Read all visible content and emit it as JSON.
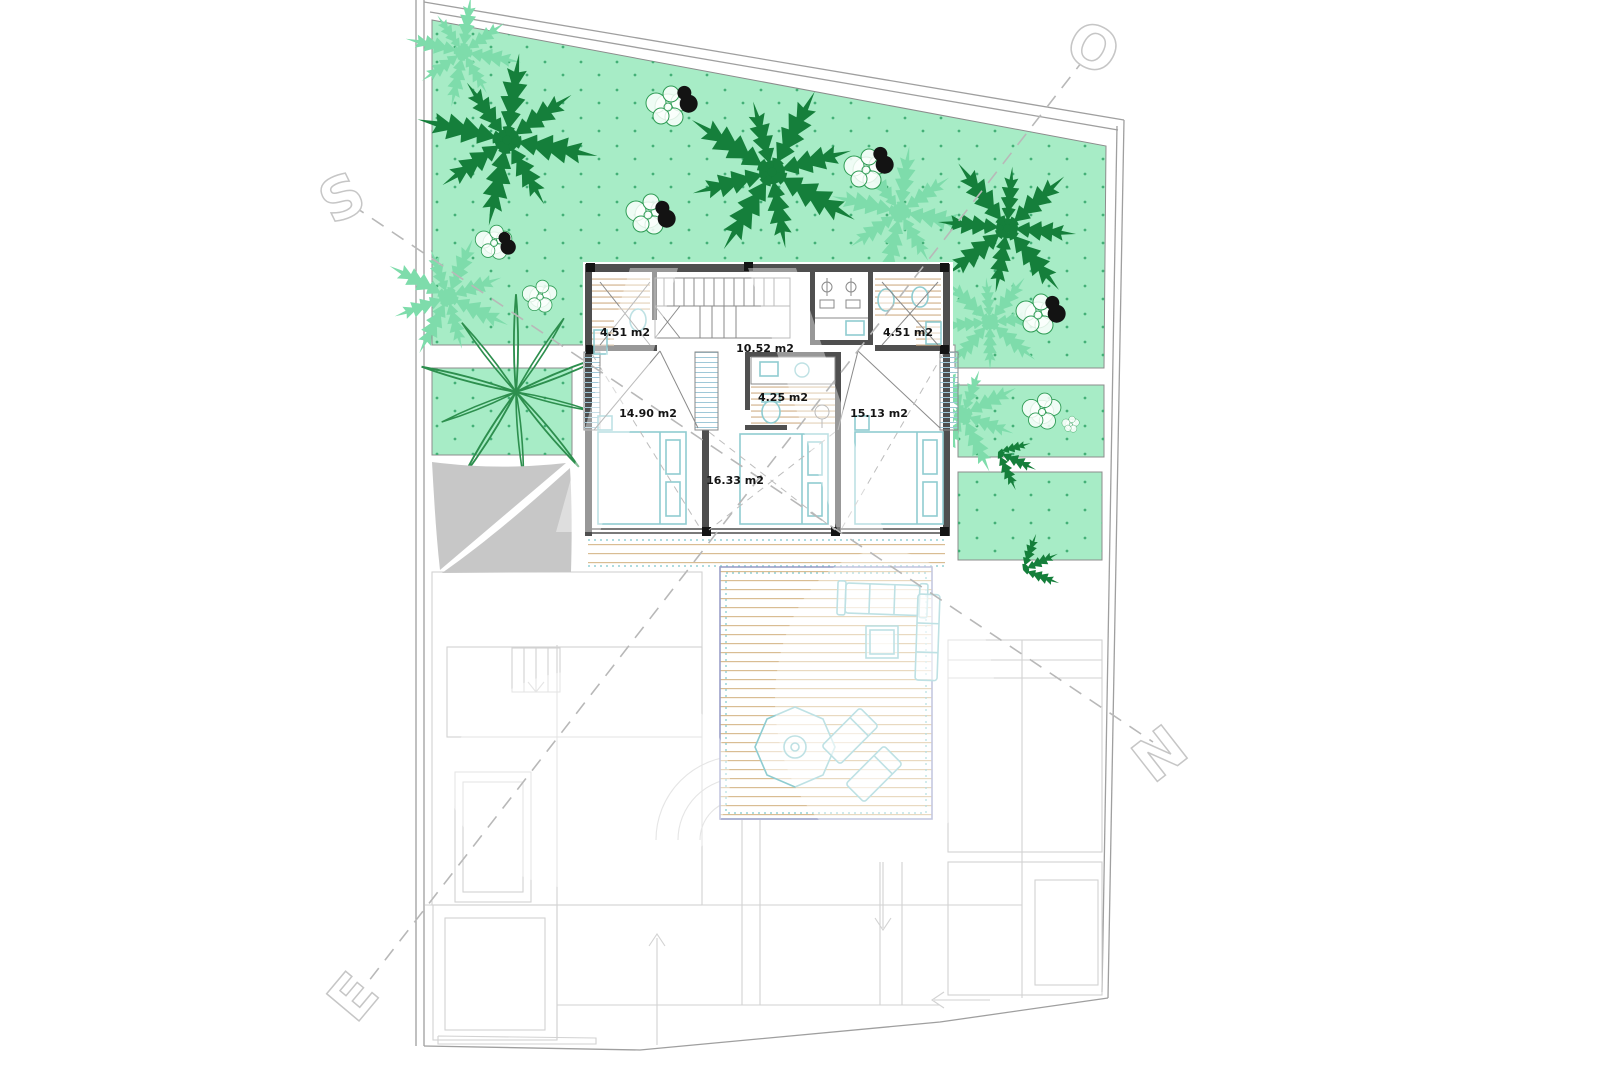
{
  "drawing": {
    "type": "villa upper-floor architectural plan with garden and roof terrace",
    "rooms": [
      {
        "id": "wardrobe-left",
        "area": "4.51 m2"
      },
      {
        "id": "hall-stairs",
        "area": "10.52 m2"
      },
      {
        "id": "wardrobe-right",
        "area": "4.51 m2"
      },
      {
        "id": "bedroom-left",
        "area": "14.90 m2"
      },
      {
        "id": "bathroom",
        "area": "4.25 m2"
      },
      {
        "id": "bedroom-right",
        "area": "15.13 m2"
      },
      {
        "id": "bedroom-middle",
        "area": "16.33 m2"
      }
    ],
    "compass": {
      "o": "O",
      "s": "S",
      "n": "N",
      "e": "E"
    }
  },
  "colors": {
    "garden_green": "#a7ecc6",
    "garden_dot": "#44b077",
    "palm_dark": "#157f3b",
    "palm_light": "#7edcab",
    "agave_green": "#2d8f4e",
    "bush_stroke": "#2f9c55",
    "blob_black": "#131313",
    "wall_gray": "#4f4f4f",
    "faint_gray": "#d2d2d2",
    "deck_tan": "#d9bd93",
    "deck_edge": "#9aa0c8",
    "furniture_teal": "#8fccd0",
    "shade_gray": "#c7c7c7",
    "dash_gray": "#b8b8b8"
  }
}
